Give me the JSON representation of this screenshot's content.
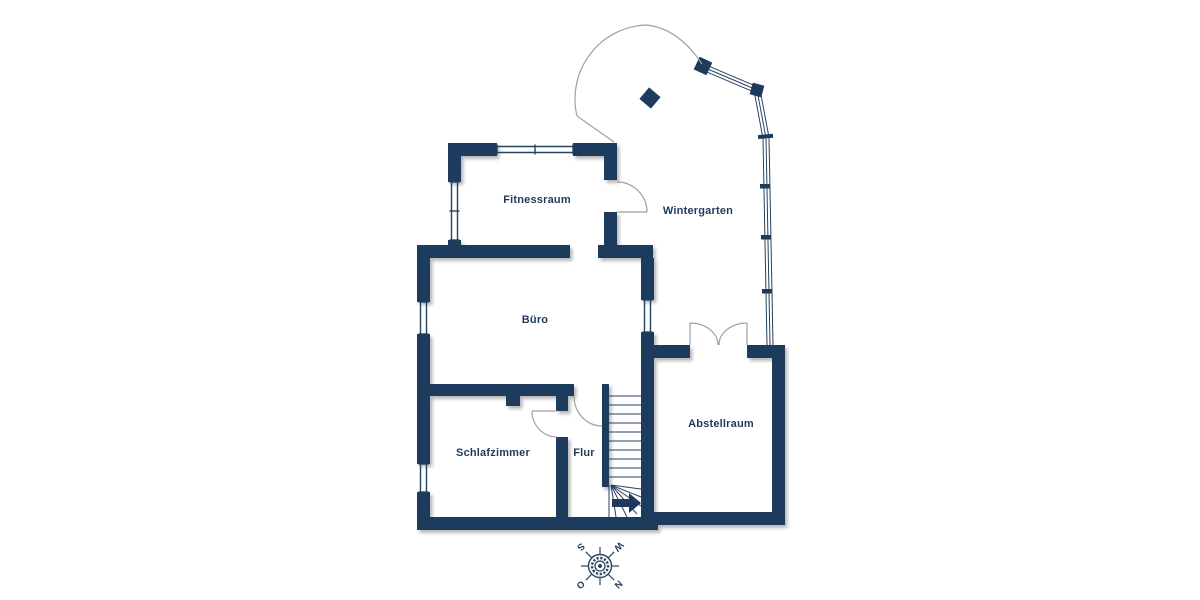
{
  "plan": {
    "type": "floor-plan",
    "rooms": [
      {
        "id": "fitnessraum",
        "label": "Fitnessraum"
      },
      {
        "id": "wintergarten",
        "label": "Wintergarten"
      },
      {
        "id": "buero",
        "label": "Büro"
      },
      {
        "id": "schlafzimmer",
        "label": "Schlafzimmer"
      },
      {
        "id": "flur",
        "label": "Flur"
      },
      {
        "id": "abstellraum",
        "label": "Abstellraum"
      }
    ],
    "compass": {
      "north": "N",
      "east": "O",
      "south": "S",
      "west": "W"
    },
    "colors": {
      "wall": "#1e3b5d",
      "door_line": "#9aa1ab",
      "thin_line": "#27425f",
      "background": "#ffffff"
    }
  }
}
